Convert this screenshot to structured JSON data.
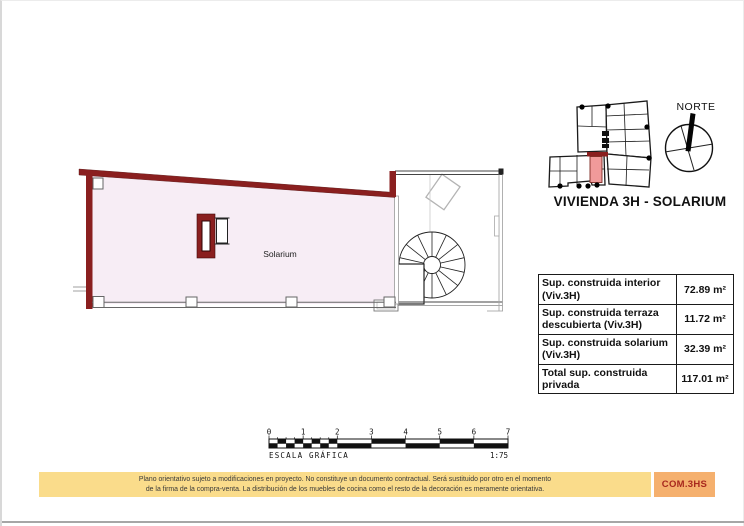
{
  "locator": {
    "compass_label": "NORTE",
    "title": "VIVIENDA 3H - SOLARIUM"
  },
  "plan": {
    "room_label": "Solarium"
  },
  "areas_table": {
    "rows": [
      {
        "label": "Sup. construida interior (Viv.3H)",
        "value": "72.89 m²"
      },
      {
        "label": "Sup. construida terraza descubierta (Viv.3H)",
        "value": "11.72 m²"
      },
      {
        "label": "Sup. construida solarium (Viv.3H)",
        "value": "32.39 m²"
      },
      {
        "label": "Total sup. construida privada",
        "value": "117.01 m²"
      }
    ]
  },
  "scale_bar": {
    "ticks": [
      "0",
      "1",
      "2",
      "3",
      "4",
      "5",
      "6",
      "7"
    ],
    "caption": "ESCALA GRÁFICA",
    "ratio": "1:75"
  },
  "footer": {
    "disclaimer_line1": "Plano orientativo sujeto a modificaciones en proyecto. No constituye un documento contractual. Será sustituido por otro en el momento",
    "disclaimer_line2": "de la firma de la compra-venta. La distribución de los muebles de cocina como el resto de la decoración es meramente orientativa.",
    "code": "COM.3HS"
  },
  "colors": {
    "wall_red": "#8a1f1f",
    "solarium_fill": "#f7edf5",
    "locator_highlight": "#f09a9a",
    "disclaimer_bg": "#fadc8b",
    "code_bg": "#f5b06e",
    "code_text": "#a8281e"
  }
}
